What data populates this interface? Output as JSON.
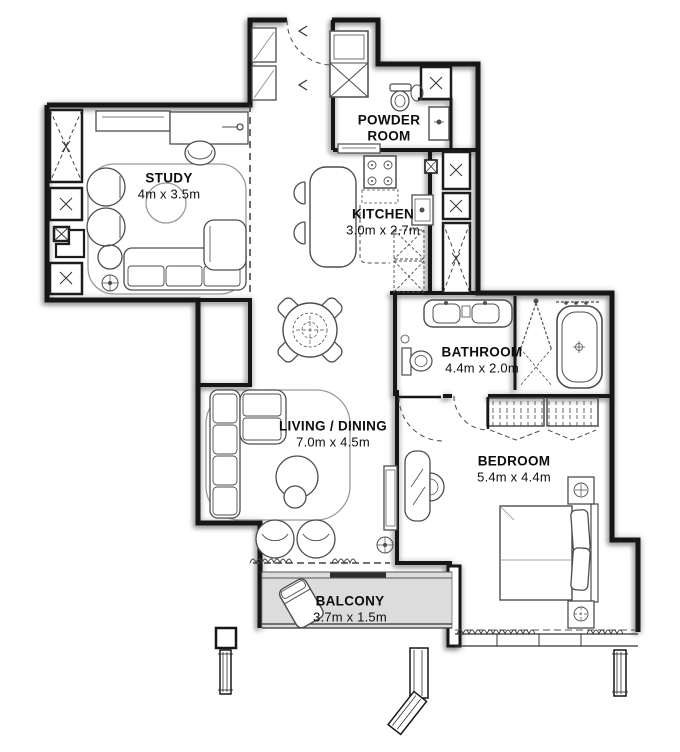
{
  "plan": {
    "rooms": {
      "study": {
        "name": "STUDY",
        "dims": "4m x 3.5m"
      },
      "powder_room": {
        "name": "POWDER ROOM"
      },
      "kitchen": {
        "name": "KITCHEN",
        "dims": "3.0m x 2.7m"
      },
      "bathroom": {
        "name": "BATHROOM",
        "dims": "4.4m x 2.0m"
      },
      "living_dining": {
        "name": "LIVING / DINING",
        "dims": "7.0m x 4.5m"
      },
      "bedroom": {
        "name": "BEDROOM",
        "dims": "5.4m x 4.4m"
      },
      "balcony": {
        "name": "BALCONY",
        "dims": "3.7m x 1.5m"
      }
    },
    "colors": {
      "wall": "#161616",
      "furniture_line": "#4d4d4d",
      "balcony_floor": "#dcdcdc",
      "shadow": "#b5b5b5",
      "background": "#ffffff",
      "label_text": "#0d0d0d"
    }
  }
}
